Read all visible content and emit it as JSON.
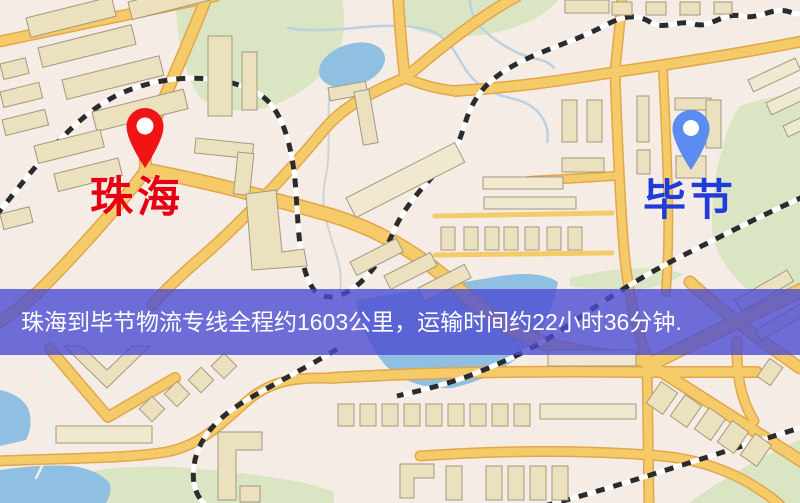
{
  "map": {
    "origin": {
      "name": "珠海",
      "label_color": "#e60012",
      "pin_color": "#f01414",
      "pin_style": "red-teardrop-marker"
    },
    "destination": {
      "name": "毕节",
      "label_color": "#1f3dd6",
      "pin_color": "#5b8cf0",
      "pin_style": "blue-teardrop-marker"
    },
    "banner": {
      "text": "珠海到毕节物流专线全程约1603公里，运输时间约22小时36分钟.",
      "route_distance": "约1603公里",
      "route_duration": "约22小时36分钟",
      "background_color": "rgba(76,76,210,0.8)",
      "text_color": "#ffffff"
    },
    "map_colors": {
      "background": "#f6ece6",
      "road_fill": "#f5cb69",
      "road_casing": "#e2a64b",
      "building": "#ece1bf",
      "park": "#d9e5c3",
      "water": "#8fc0e2",
      "railway": "#2b2b2b"
    }
  }
}
